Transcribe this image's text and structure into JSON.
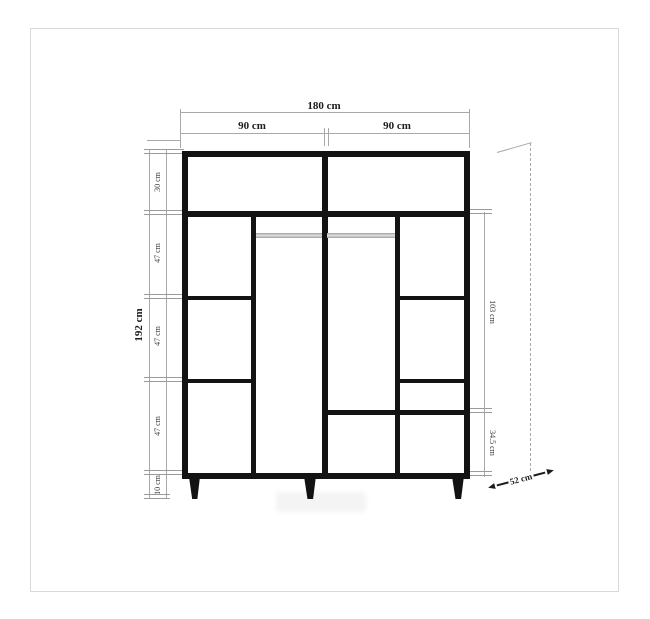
{
  "labels": {
    "total_width": "180 cm",
    "left_section_width": "90 cm",
    "right_section_width": "90 cm",
    "total_height": "192 cm",
    "top_shelf_height": "30 cm",
    "upper_shelf_height": "47 cm",
    "middle_shelf_height": "47 cm",
    "lower_shelf_height": "47 cm",
    "leg_height": "10 cm",
    "hanging_section_height": "103 cm",
    "bottom_section_height": "34.5 cm",
    "depth": "52 cm"
  },
  "colors": {
    "structure": "#131313",
    "dimension_lines": "#a9a9a9",
    "hanger_rod": "#b8b8b8",
    "frame_border": "#d9d9d9",
    "background": "#ffffff"
  }
}
